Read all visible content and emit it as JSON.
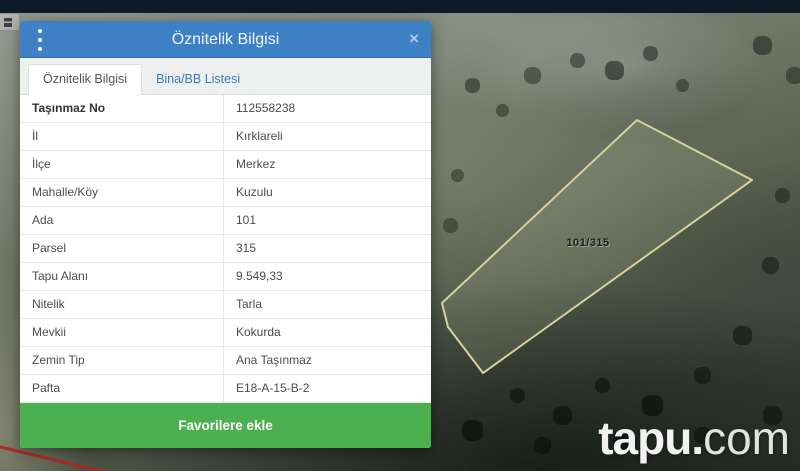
{
  "dialog": {
    "title": "Öznitelik Bilgisi",
    "close_icon": "×",
    "tabs": [
      {
        "label": "Öznitelik Bilgisi",
        "active": true
      },
      {
        "label": "Bina/BB Listesi",
        "active": false
      }
    ],
    "fields": [
      {
        "label": "Taşınmaz No",
        "value": "112558238"
      },
      {
        "label": "İl",
        "value": "Kırklareli"
      },
      {
        "label": "İlçe",
        "value": "Merkez"
      },
      {
        "label": "Mahalle/Köy",
        "value": "Kuzulu"
      },
      {
        "label": "Ada",
        "value": "101"
      },
      {
        "label": "Parsel",
        "value": "315"
      },
      {
        "label": "Tapu Alanı",
        "value": "9.549,33"
      },
      {
        "label": "Nitelik",
        "value": "Tarla"
      },
      {
        "label": "Mevkii",
        "value": "Kokurda"
      },
      {
        "label": "Zemin Tip",
        "value": "Ana Taşınmaz"
      },
      {
        "label": "Pafta",
        "value": "E18-A-15-B-2"
      }
    ],
    "favorite_button_label": "Favorilere ekle"
  },
  "map": {
    "parcel_label": "101/315",
    "watermark_bold": "tapu.",
    "watermark_light": "com"
  },
  "colors": {
    "navbar": "#0D1A28",
    "dialog_header_blue": "#3D80C4",
    "tab_link_blue": "#3A7AB8",
    "favorite_green": "#4CAF50",
    "parcel_outline": "#D8D09B",
    "boundary_red": "#B3271E"
  }
}
